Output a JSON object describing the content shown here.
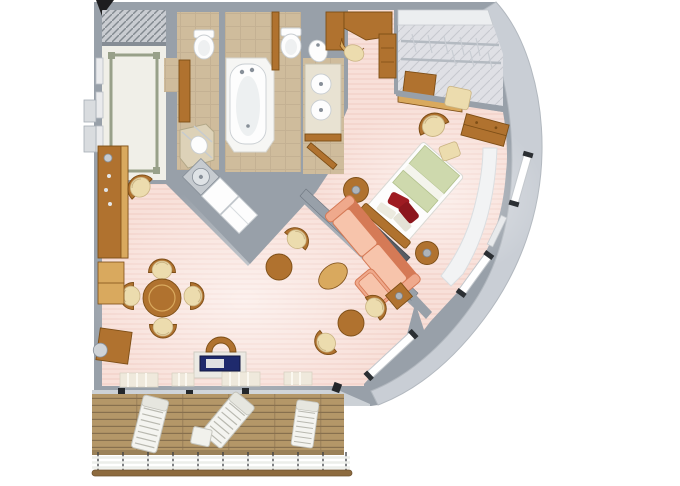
{
  "image": {
    "type": "3d-floorplan-render",
    "subject": "cruise-ship-suite-floor-plan-top-view"
  },
  "canvas": {
    "width": 680,
    "height": 486
  },
  "palette": {
    "bg": "#ffffff",
    "wall": "#98a0a9",
    "wallDark": "#6f7781",
    "wallLight": "#ccd1d6",
    "hull": "#c9ced5",
    "carpet": "#f8e0d9",
    "carpetStripe": "#f2d0c7",
    "tile": "#cfbc9c",
    "tileDark": "#b3a083",
    "marble": "#f0efe8",
    "marbleTrim": "#98a089",
    "wood": "#b0722f",
    "woodLight": "#d9a95e",
    "woodDark": "#7d4e16",
    "deck": "#b49768",
    "deckLine": "#87704e",
    "sofa": "#efa98c",
    "sofaDark": "#d57a56",
    "sofaLight": "#f7c4ab",
    "sage": "#ced9ad",
    "sageDark": "#b2c18d",
    "red": "#9e1b22",
    "redDark": "#8c161d",
    "cream": "#ecdcae",
    "creamDark": "#c9b383",
    "navy": "#1f2a6d",
    "steel": "#c6cbd0",
    "steelDark": "#878f98",
    "white": "#fdfdfd",
    "closet": "#dfe0e5",
    "black": "#1d1d1f"
  },
  "rooms": [
    {
      "name": "entrance-foyer",
      "features": [
        "marble-floor",
        "entry-hatch",
        "wardrobe-doors",
        "exterior-door"
      ]
    },
    {
      "name": "guest-bathroom",
      "features": [
        "toilet",
        "shower",
        "corner-sink",
        "cabinet"
      ]
    },
    {
      "name": "master-bathroom",
      "features": [
        "bathtub",
        "toilet",
        "bidet",
        "double-sink-vanity"
      ]
    },
    {
      "name": "dressing-area",
      "features": [
        "vanity-desk",
        "stool",
        "wardrobe-cabinet"
      ]
    },
    {
      "name": "walk-in-closet",
      "features": [
        "shelf",
        "hanging-rails",
        "dresser",
        "lowboard"
      ]
    },
    {
      "name": "bedroom",
      "features": [
        "double-bed",
        "red-pillows",
        "nightstands",
        "armchair",
        "ottoman",
        "bench",
        "dresser",
        "media-console",
        "hull-windows",
        "window-ledge"
      ]
    },
    {
      "name": "living-dining-room",
      "features": [
        "sectional-sofa",
        "end-table",
        "oval-coffee-table",
        "round-side-tables",
        "armchairs",
        "dining-table",
        "dining-chairs",
        "sideboard-bar",
        "low-cabinet",
        "corner-cabinet-lamp",
        "writing-desk",
        "desk-chair",
        "wet-bar",
        "door-thresholds"
      ]
    },
    {
      "name": "veranda",
      "features": [
        "teak-deck",
        "sun-loungers",
        "deck-table",
        "railing",
        "handrail"
      ]
    }
  ]
}
